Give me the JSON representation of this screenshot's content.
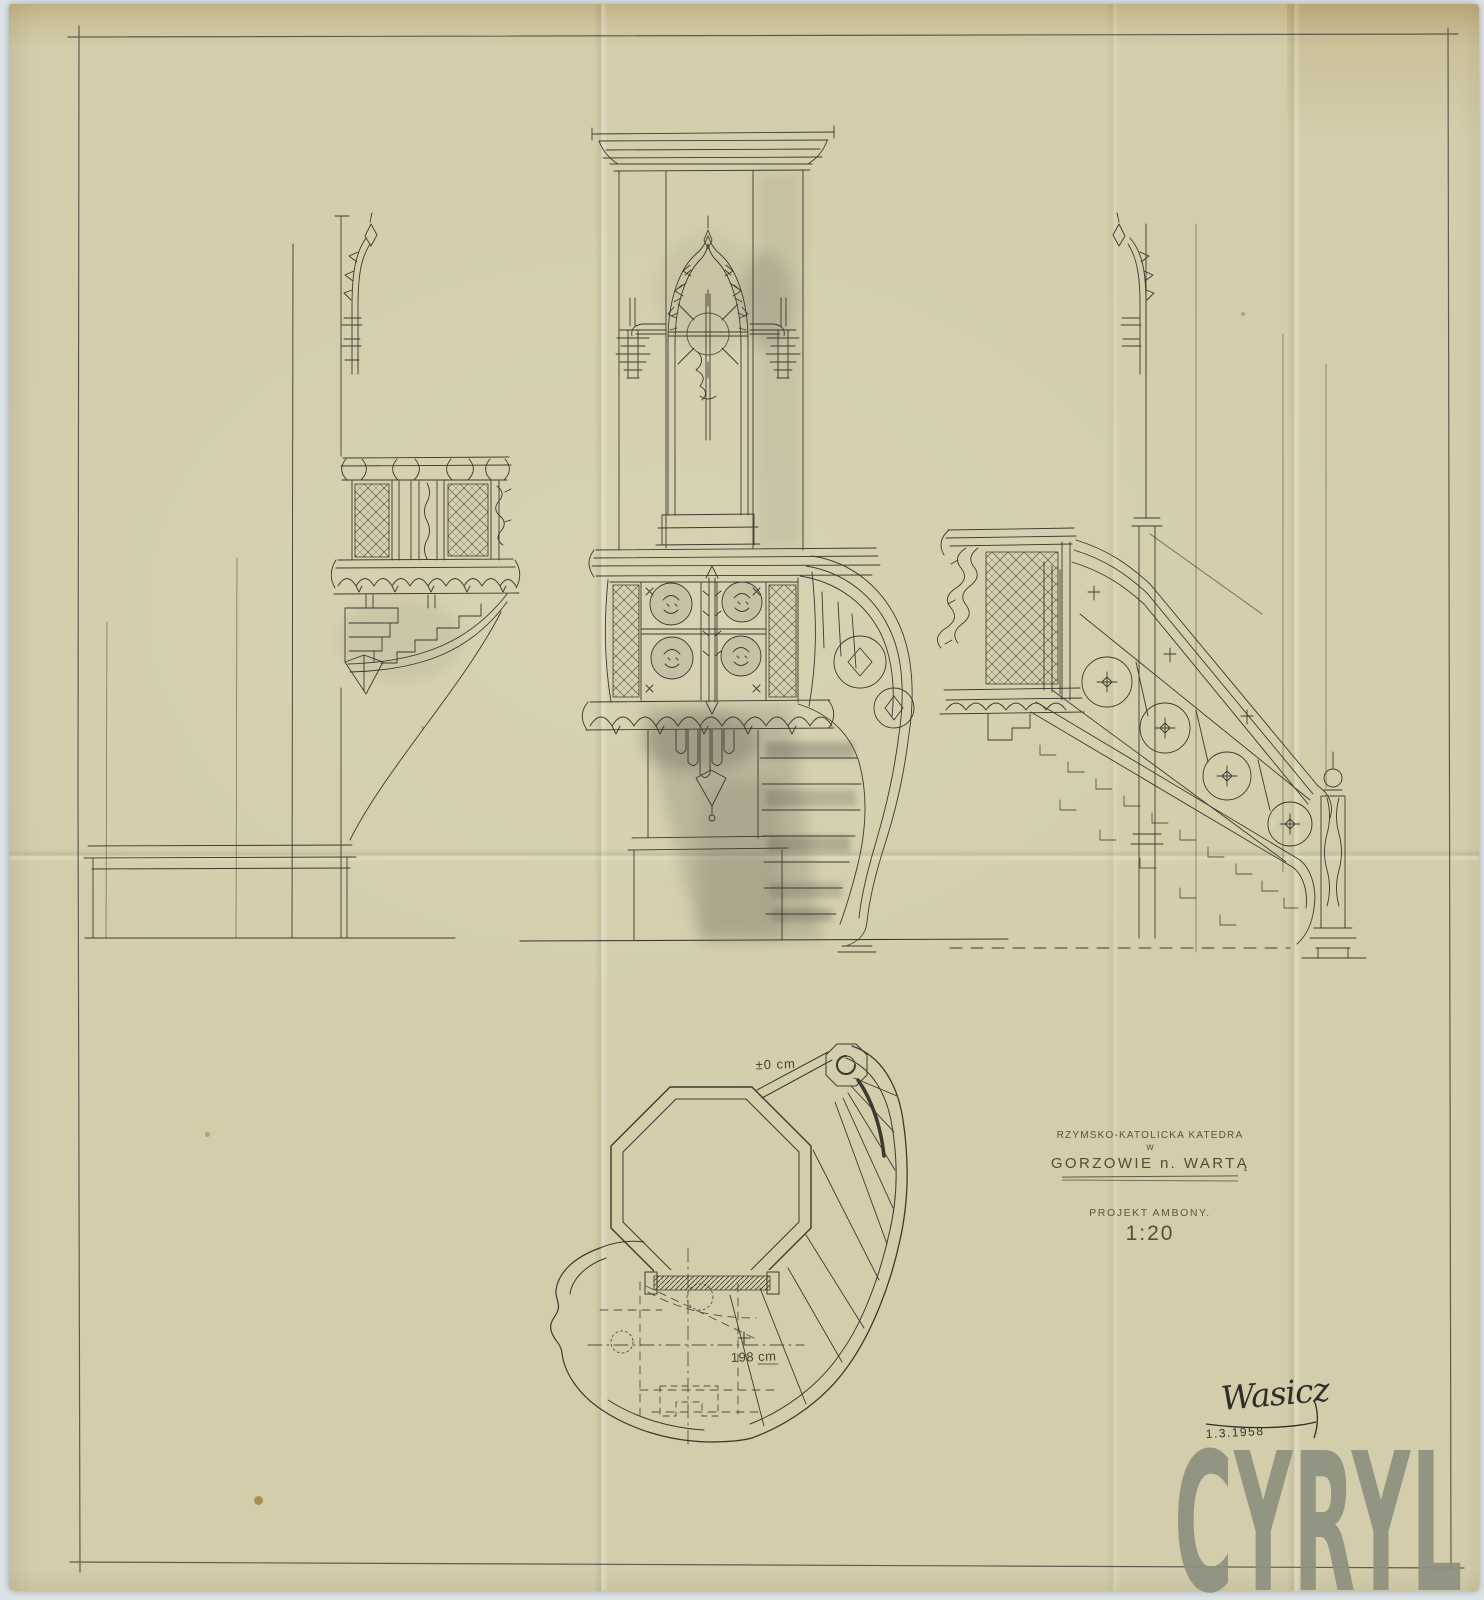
{
  "palette": {
    "background": "#dce3e6",
    "paper": "#d3cdab",
    "paper_top_band": "#b59a66",
    "ink": "#3c3a2f",
    "pencil_wash": "#55544a",
    "watermark_gray": "#8e9180"
  },
  "title_block": {
    "line1": "RZYMSKO-KATOLICKA KATEDRA",
    "line2": "w",
    "line3": "GORZOWIE n. WARTĄ",
    "subtitle": "PROJEKT AMBONY.",
    "scale": "1:20"
  },
  "plan": {
    "level_zero": "±0 cm",
    "level_plus_sign": "+",
    "level_plus": "198 cm"
  },
  "signature": {
    "name": "Wasicz",
    "date": "1.3.1958"
  },
  "watermark": {
    "text": "CYRYL"
  }
}
